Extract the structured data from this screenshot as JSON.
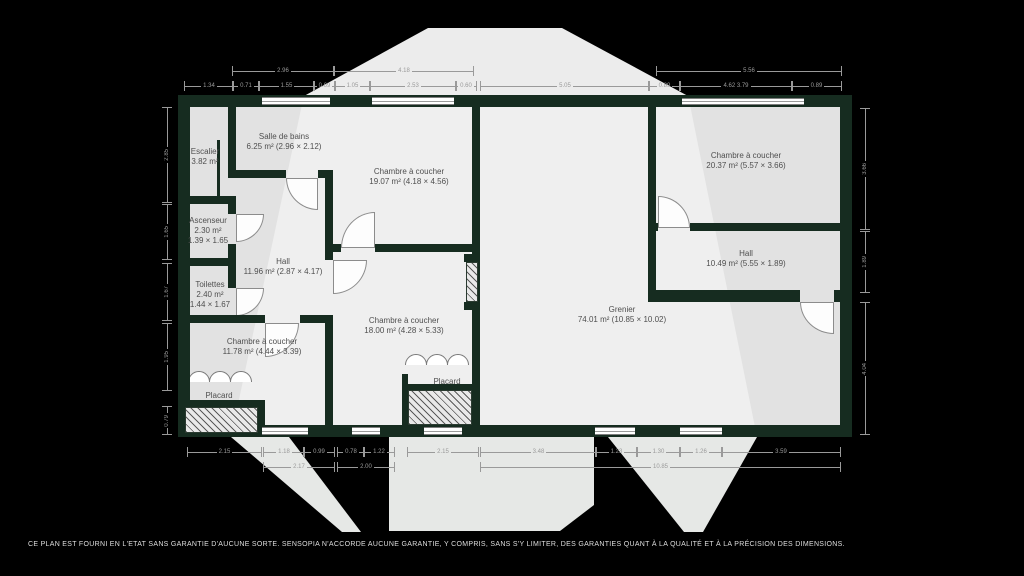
{
  "colors": {
    "background": "#000000",
    "wall": "#162c20",
    "room_fill": "#e2e2e2",
    "watermark": "#e9ebe9",
    "dimension_text": "#9a9a9a",
    "label_text": "#4f4f4f"
  },
  "rooms": [
    {
      "id": "escalier",
      "lines": [
        "Escalier",
        "3.82 m²"
      ]
    },
    {
      "id": "salle-de-bains",
      "lines": [
        "Salle de bains",
        "6.25 m² (2.96 × 2.12)"
      ]
    },
    {
      "id": "chambre-1",
      "lines": [
        "Chambre à coucher",
        "19.07 m² (4.18 × 4.56)"
      ]
    },
    {
      "id": "chambre-2",
      "lines": [
        "Chambre à coucher",
        "20.37 m² (5.57 × 3.66)"
      ]
    },
    {
      "id": "ascenseur",
      "lines": [
        "Ascenseur",
        "2.30 m²",
        "1.39 × 1.65"
      ]
    },
    {
      "id": "toilettes",
      "lines": [
        "Toilettes",
        "2.40 m²",
        "1.44 × 1.67"
      ]
    },
    {
      "id": "hall-1",
      "lines": [
        "Hall",
        "11.96 m² (2.87 × 4.17)"
      ]
    },
    {
      "id": "hall-2",
      "lines": [
        "Hall",
        "10.49 m² (5.55 × 1.89)"
      ]
    },
    {
      "id": "chambre-3",
      "lines": [
        "Chambre à coucher",
        "11.78 m² (4.44 × 3.39)"
      ]
    },
    {
      "id": "chambre-4",
      "lines": [
        "Chambre à coucher",
        "18.00 m² (4.28 × 5.33)"
      ]
    },
    {
      "id": "grenier",
      "lines": [
        "Grenier",
        "74.01 m² (10.85 × 10.02)"
      ]
    },
    {
      "id": "placard-1",
      "lines": [
        "Placard"
      ]
    },
    {
      "id": "placard-2",
      "lines": [
        "Placard"
      ]
    }
  ],
  "dims": {
    "items": [
      {
        "v": "2.96",
        "o": "h",
        "x": 232,
        "y": 66,
        "l": 100
      },
      {
        "v": "4.18",
        "o": "h",
        "x": 334,
        "y": 66,
        "l": 138
      },
      {
        "v": "5.56",
        "o": "h",
        "x": 656,
        "y": 66,
        "l": 184
      },
      {
        "v": "1.34",
        "o": "h",
        "x": 184,
        "y": 81,
        "l": 48
      },
      {
        "v": "0.71",
        "o": "h",
        "x": 232,
        "y": 81,
        "l": 26
      },
      {
        "v": "1.55",
        "o": "h",
        "x": 258,
        "y": 81,
        "l": 55
      },
      {
        "v": "0.69",
        "o": "h",
        "x": 313,
        "y": 81,
        "l": 21
      },
      {
        "v": "1.05",
        "o": "h",
        "x": 334,
        "y": 81,
        "l": 35
      },
      {
        "v": "2.53",
        "o": "h",
        "x": 369,
        "y": 81,
        "l": 86
      },
      {
        "v": "0.60",
        "o": "h",
        "x": 455,
        "y": 81,
        "l": 20
      },
      {
        "v": "5.05",
        "o": "h",
        "x": 480,
        "y": 81,
        "l": 168
      },
      {
        "v": "0.89",
        "o": "h",
        "x": 648,
        "y": 81,
        "l": 31
      },
      {
        "v": "4.62 3.79",
        "o": "h",
        "x": 679,
        "y": 81,
        "l": 112
      },
      {
        "v": "0.89",
        "o": "h",
        "x": 791,
        "y": 81,
        "l": 49
      },
      {
        "v": "2.85",
        "o": "v",
        "x": 162,
        "y": 107,
        "l": 94
      },
      {
        "v": "1.65",
        "o": "v",
        "x": 162,
        "y": 204,
        "l": 54
      },
      {
        "v": "1.67",
        "o": "v",
        "x": 162,
        "y": 263,
        "l": 56
      },
      {
        "v": "1.95",
        "o": "v",
        "x": 162,
        "y": 323,
        "l": 66
      },
      {
        "v": "0.79",
        "o": "v",
        "x": 162,
        "y": 406,
        "l": 27
      },
      {
        "v": "3.66",
        "o": "v",
        "x": 860,
        "y": 108,
        "l": 120
      },
      {
        "v": "1.89",
        "o": "v",
        "x": 860,
        "y": 231,
        "l": 60
      },
      {
        "v": "4.04",
        "o": "v",
        "x": 860,
        "y": 302,
        "l": 131
      },
      {
        "v": "2.15",
        "o": "h",
        "x": 187,
        "y": 447,
        "l": 73
      },
      {
        "v": "1.18",
        "o": "h",
        "x": 263,
        "y": 447,
        "l": 40
      },
      {
        "v": "0.99",
        "o": "h",
        "x": 303,
        "y": 447,
        "l": 30
      },
      {
        "v": "0.78",
        "o": "h",
        "x": 337,
        "y": 447,
        "l": 26
      },
      {
        "v": "1.22",
        "o": "h",
        "x": 363,
        "y": 447,
        "l": 30
      },
      {
        "v": "2.15",
        "o": "h",
        "x": 407,
        "y": 447,
        "l": 70
      },
      {
        "v": "3.48",
        "o": "h",
        "x": 480,
        "y": 447,
        "l": 115
      },
      {
        "v": "1.23",
        "o": "h",
        "x": 595,
        "y": 447,
        "l": 41
      },
      {
        "v": "1.30",
        "o": "h",
        "x": 636,
        "y": 447,
        "l": 43
      },
      {
        "v": "1.26",
        "o": "h",
        "x": 679,
        "y": 447,
        "l": 42
      },
      {
        "v": "3.59",
        "o": "h",
        "x": 721,
        "y": 447,
        "l": 118
      },
      {
        "v": "2.17",
        "o": "h",
        "x": 263,
        "y": 462,
        "l": 70
      },
      {
        "v": "2.00",
        "o": "h",
        "x": 337,
        "y": 462,
        "l": 56
      },
      {
        "v": "10.85",
        "o": "h",
        "x": 480,
        "y": 462,
        "l": 359
      }
    ]
  },
  "disclaimer": "CE PLAN EST FOURNI EN L'ETAT SANS GARANTIE D'AUCUNE SORTE. SENSOPIA N'ACCORDE AUCUNE GARANTIE, Y COMPRIS, SANS S'Y LIMITER, DES GARANTIES QUANT À LA QUALITÉ ET À LA PRÉCISION DES DIMENSIONS."
}
